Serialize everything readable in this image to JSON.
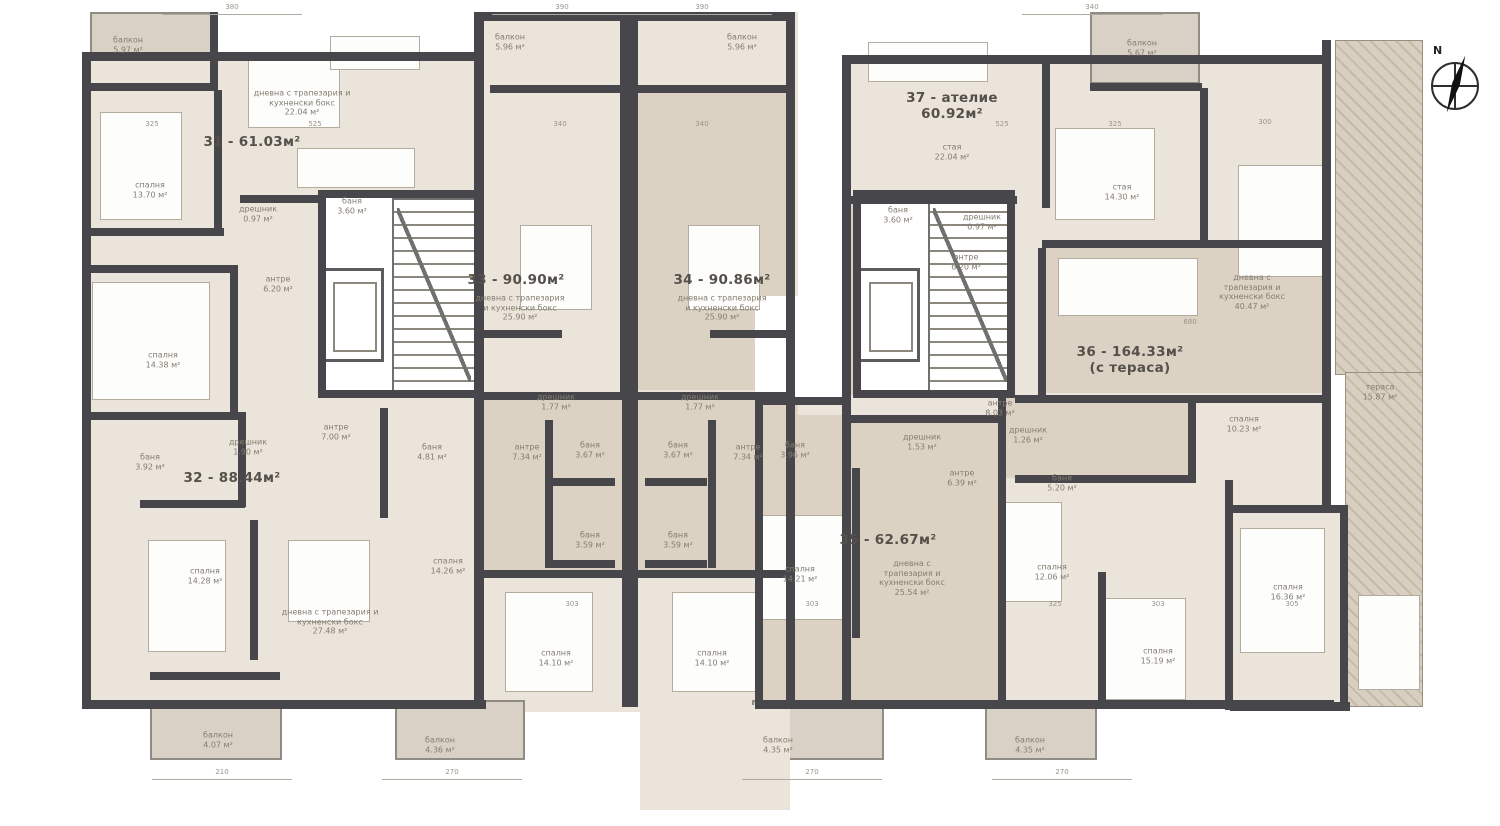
{
  "plan": {
    "compass_label": "N",
    "area_unit": "м²"
  },
  "apartments": [
    {
      "label": "31 - 61.03м²",
      "x": 252,
      "y": 142
    },
    {
      "label": "32 - 88.44м²",
      "x": 232,
      "y": 478
    },
    {
      "label": "33 - 90.90м²",
      "x": 516,
      "y": 280
    },
    {
      "label": "34 - 90.86м²",
      "x": 722,
      "y": 280
    },
    {
      "label": "35 - 62.67м²",
      "x": 888,
      "y": 540
    },
    {
      "label": "36 - 164.33м²",
      "sub": "(с тераса)",
      "x": 1130,
      "y": 360
    },
    {
      "label": "37 - ателие",
      "sub": "60.92м²",
      "x": 952,
      "y": 106
    }
  ],
  "rooms": [
    {
      "name": "балкон",
      "area": "5.97 м²",
      "x": 128,
      "y": 45
    },
    {
      "name": "дневна с трапезария и кухненски бокс",
      "area": "22.04 м²",
      "x": 302,
      "y": 103,
      "w": 104
    },
    {
      "name": "спалня",
      "area": "13.70 м²",
      "x": 150,
      "y": 190
    },
    {
      "name": "баня",
      "area": "3.60 м²",
      "x": 352,
      "y": 206
    },
    {
      "name": "дрешник",
      "area": "0.97 м²",
      "x": 258,
      "y": 214
    },
    {
      "name": "антре",
      "area": "6.20 м²",
      "x": 278,
      "y": 284
    },
    {
      "name": "спалня",
      "area": "14.38 м²",
      "x": 163,
      "y": 360
    },
    {
      "name": "баня",
      "area": "3.92 м²",
      "x": 150,
      "y": 462
    },
    {
      "name": "дрешник",
      "area": "1.90 м²",
      "x": 248,
      "y": 447
    },
    {
      "name": "антре",
      "area": "7.00 м²",
      "x": 336,
      "y": 432
    },
    {
      "name": "спалня",
      "area": "14.28 м²",
      "x": 205,
      "y": 576
    },
    {
      "name": "дневна с трапезария и кухненски бокс",
      "area": "27.48 м²",
      "x": 330,
      "y": 622,
      "w": 110
    },
    {
      "name": "балкон",
      "area": "4.07 м²",
      "x": 218,
      "y": 740
    },
    {
      "name": "балкон",
      "area": "5.96 м²",
      "x": 510,
      "y": 42
    },
    {
      "name": "балкон",
      "area": "5.96 м²",
      "x": 742,
      "y": 42
    },
    {
      "name": "дневна с трапезария и кухненски бокс",
      "area": "25.90 м²",
      "x": 520,
      "y": 308,
      "w": 92
    },
    {
      "name": "дневна с трапезария и кухненски бокс",
      "area": "25.90 м²",
      "x": 722,
      "y": 308,
      "w": 92
    },
    {
      "name": "дрешник",
      "area": "1.77 м²",
      "x": 556,
      "y": 402
    },
    {
      "name": "дрешник",
      "area": "1.77 м²",
      "x": 700,
      "y": 402
    },
    {
      "name": "антре",
      "area": "7.34 м²",
      "x": 527,
      "y": 452
    },
    {
      "name": "антре",
      "area": "7.34 м²",
      "x": 748,
      "y": 452
    },
    {
      "name": "баня",
      "area": "3.67 м²",
      "x": 590,
      "y": 450
    },
    {
      "name": "баня",
      "area": "3.67 м²",
      "x": 678,
      "y": 450
    },
    {
      "name": "баня",
      "area": "3.59 м²",
      "x": 590,
      "y": 540
    },
    {
      "name": "баня",
      "area": "3.59 м²",
      "x": 678,
      "y": 540
    },
    {
      "name": "баня",
      "area": "4.81 м²",
      "x": 432,
      "y": 452
    },
    {
      "name": "спалня",
      "area": "14.26 м²",
      "x": 448,
      "y": 566
    },
    {
      "name": "спалня",
      "area": "14.10 м²",
      "x": 556,
      "y": 658
    },
    {
      "name": "спалня",
      "area": "14.10 м²",
      "x": 712,
      "y": 658
    },
    {
      "name": "балкон",
      "area": "4.36 м²",
      "x": 440,
      "y": 745
    },
    {
      "name": "балкон",
      "area": "4.35 м²",
      "x": 778,
      "y": 745
    },
    {
      "name": "баня",
      "area": "3.96 м²",
      "x": 795,
      "y": 450
    },
    {
      "name": "дрешник",
      "area": "1.53 м²",
      "x": 922,
      "y": 442
    },
    {
      "name": "антре",
      "area": "6.39 м²",
      "x": 962,
      "y": 478
    },
    {
      "name": "спалня",
      "area": "14.21 м²",
      "x": 800,
      "y": 574
    },
    {
      "name": "дневна с трапезария и кухненски бокс",
      "area": "25.54 м²",
      "x": 912,
      "y": 578,
      "w": 80
    },
    {
      "name": "балкон",
      "area": "4.35 м²",
      "x": 1030,
      "y": 745
    },
    {
      "name": "стая",
      "area": "22.04 м²",
      "x": 952,
      "y": 152
    },
    {
      "name": "балкон",
      "area": "5.67 м²",
      "x": 1142,
      "y": 48
    },
    {
      "name": "стая",
      "area": "14.30 м²",
      "x": 1122,
      "y": 192
    },
    {
      "name": "баня",
      "area": "3.60 м²",
      "x": 898,
      "y": 215
    },
    {
      "name": "дрешник",
      "area": "0.97 м²",
      "x": 982,
      "y": 222
    },
    {
      "name": "антре",
      "area": "6.20 м²",
      "x": 966,
      "y": 262
    },
    {
      "name": "дневна с трапезария и кухненски бокс",
      "area": "40.47 м²",
      "x": 1252,
      "y": 292,
      "w": 86
    },
    {
      "name": "антре",
      "area": "8.03 м²",
      "x": 1000,
      "y": 408
    },
    {
      "name": "дрешник",
      "area": "1.26 м²",
      "x": 1028,
      "y": 435
    },
    {
      "name": "баня",
      "area": "5.20 м²",
      "x": 1062,
      "y": 483
    },
    {
      "name": "спалня",
      "area": "10.23 м²",
      "x": 1244,
      "y": 424
    },
    {
      "name": "спалня",
      "area": "12.06 м²",
      "x": 1052,
      "y": 572
    },
    {
      "name": "спалня",
      "area": "15.19 м²",
      "x": 1158,
      "y": 656
    },
    {
      "name": "спалня",
      "area": "16.36 м²",
      "x": 1288,
      "y": 592
    },
    {
      "name": "тераса",
      "area": "15.87 м²",
      "x": 1380,
      "y": 392
    }
  ],
  "dimensions": {
    "top": [
      {
        "text": "380",
        "x": 232,
        "y": 3
      },
      {
        "text": "390",
        "x": 562,
        "y": 3
      },
      {
        "text": "390",
        "x": 702,
        "y": 3
      },
      {
        "text": "340",
        "x": 1092,
        "y": 3
      }
    ],
    "bottom": [
      {
        "text": "210",
        "x": 222,
        "y": 768
      },
      {
        "text": "270",
        "x": 452,
        "y": 768
      },
      {
        "text": "270",
        "x": 812,
        "y": 768
      },
      {
        "text": "270",
        "x": 1062,
        "y": 768
      }
    ],
    "marks": [
      {
        "text": "325",
        "x": 152,
        "y": 120
      },
      {
        "text": "525",
        "x": 315,
        "y": 120
      },
      {
        "text": "340",
        "x": 560,
        "y": 120
      },
      {
        "text": "340",
        "x": 702,
        "y": 120
      },
      {
        "text": "525",
        "x": 1002,
        "y": 120
      },
      {
        "text": "325",
        "x": 1115,
        "y": 120
      },
      {
        "text": "300",
        "x": 1265,
        "y": 118
      },
      {
        "text": "680",
        "x": 1190,
        "y": 318
      },
      {
        "text": "303",
        "x": 572,
        "y": 600
      },
      {
        "text": "303",
        "x": 812,
        "y": 600
      },
      {
        "text": "325",
        "x": 1055,
        "y": 600
      },
      {
        "text": "303",
        "x": 1158,
        "y": 600
      },
      {
        "text": "305",
        "x": 1292,
        "y": 600
      }
    ]
  }
}
